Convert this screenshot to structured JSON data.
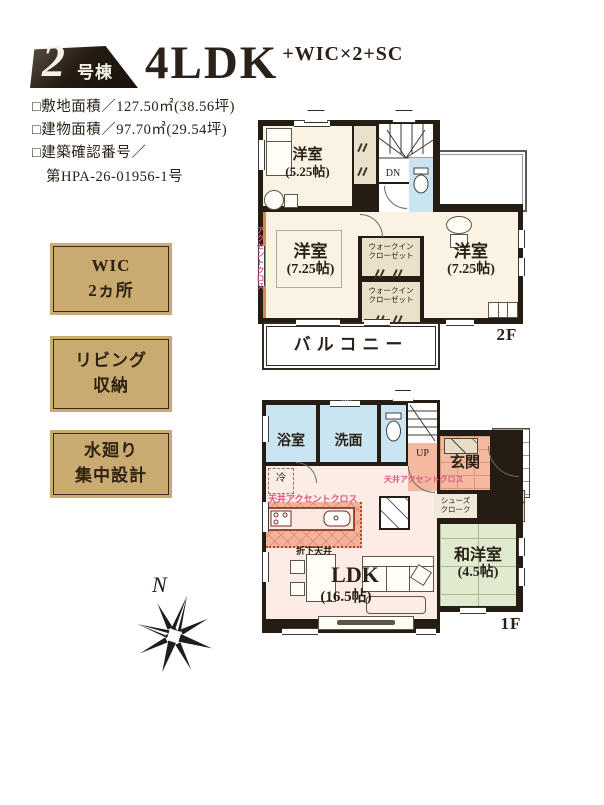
{
  "header": {
    "badge_number": "2",
    "badge_unit": "号棟",
    "title": "4LDK",
    "subtitle": "+WIC×2+SC",
    "specs": [
      "□敷地面積／127.50㎡(38.56坪)",
      "□建物面積／97.70㎡(29.54坪)",
      "□建築確認番号／",
      "第HPA-26-01956-1号"
    ]
  },
  "features": [
    {
      "lines": [
        "WIC",
        "2ヵ所"
      ]
    },
    {
      "lines": [
        "リビング",
        "収納"
      ]
    },
    {
      "lines": [
        "水廻り",
        "集中設計"
      ]
    }
  ],
  "compass": {
    "label": "N"
  },
  "floor2": {
    "label": "2F",
    "rooms": {
      "y525_1": "洋室",
      "y525_2": "(5.25帖)",
      "y725L_1": "洋室",
      "y725L_2": "(7.25帖)",
      "y725R_1": "洋室",
      "y725R_2": "(7.25帖)",
      "wic_1": "ウォークイン",
      "wic_2": "クローゼット",
      "dn": "DN",
      "balcony": "バルコニー",
      "accent_wall": "アクセントクロス"
    }
  },
  "floor1": {
    "label": "1F",
    "rooms": {
      "bath": "浴室",
      "wash": "洗面",
      "up": "UP",
      "genkan": "玄関",
      "shoes_1": "シューズ",
      "shoes_2": "クローク",
      "washitsu_1": "和洋室",
      "washitsu_2": "(4.5帖)",
      "ldk_1": "LDK",
      "ldk_2": "(16.5帖)",
      "ceiling_accent_ldk": "天井アクセントクロス",
      "ceiling_accent_hall": "天井アクセントクロス",
      "orishita": "折下天井",
      "fridge": "冷",
      "ds": "DS"
    }
  },
  "colors": {
    "wall": "#251c13",
    "room_cream": "#f8f3e3",
    "closet_beige": "#e9e1ca",
    "water_blue": "#c9e5f1",
    "ldk_pink": "#fdece6",
    "entrance_salmon": "#f3b9a1",
    "tatami_green": "#dfeacf",
    "feature_tan": "#c9aa70",
    "accent_text_pink": "#e05682"
  }
}
